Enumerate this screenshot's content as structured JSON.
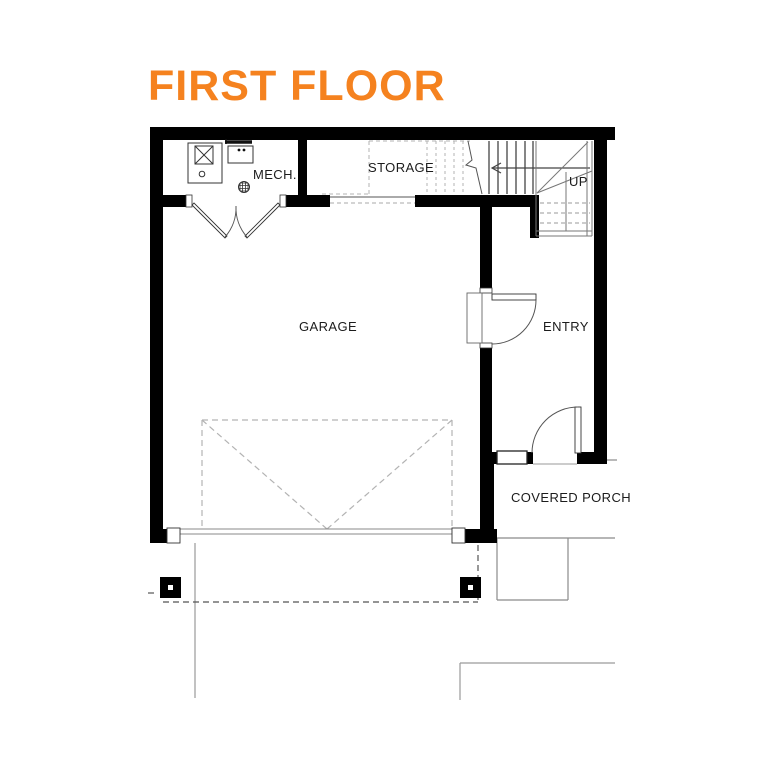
{
  "title": "FIRST FLOOR",
  "colors": {
    "accent": "#F5821F",
    "wall": "#000000"
  },
  "rooms": {
    "mech": {
      "label": "MECH."
    },
    "storage": {
      "label": "STORAGE"
    },
    "garage": {
      "label": "GARAGE"
    },
    "entry": {
      "label": "ENTRY"
    },
    "covered_porch": {
      "label": "COVERED PORCH"
    }
  },
  "stairs": {
    "direction_label": "UP"
  },
  "icons": {
    "water_heater": "water-heater-icon",
    "furnace": "furnace-icon",
    "floor_drain": "floor-drain-icon"
  }
}
